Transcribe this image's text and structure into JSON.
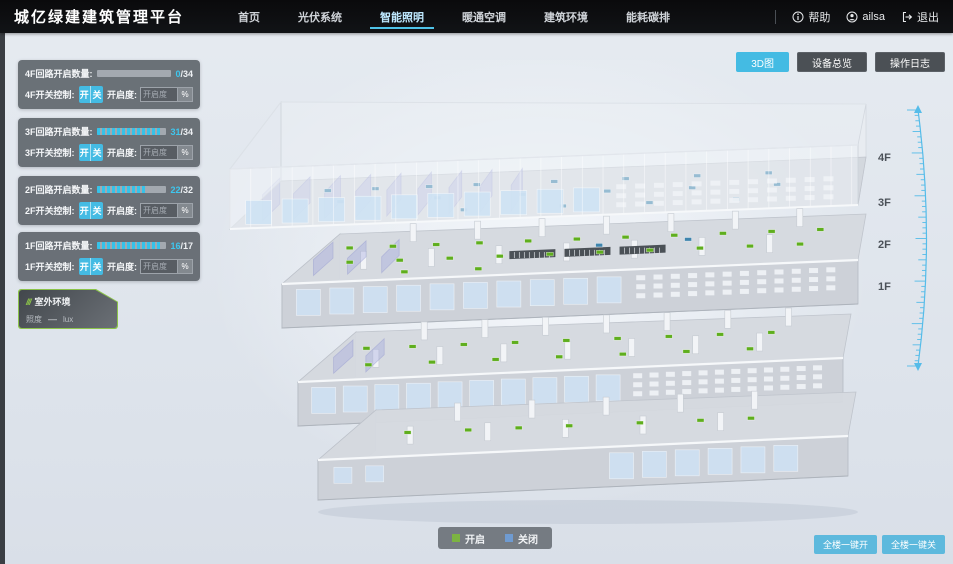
{
  "header": {
    "title": "城亿绿建建筑管理平台",
    "nav": [
      {
        "label": "首页",
        "active": false
      },
      {
        "label": "光伏系统",
        "active": false
      },
      {
        "label": "智能照明",
        "active": true
      },
      {
        "label": "暖通空调",
        "active": false
      },
      {
        "label": "建筑环境",
        "active": false
      },
      {
        "label": "能耗碳排",
        "active": false
      }
    ],
    "help": "帮助",
    "user": "ailsa",
    "logout": "退出"
  },
  "view_buttons": [
    {
      "label": "3D图",
      "active": true
    },
    {
      "label": "设备总览",
      "active": false
    },
    {
      "label": "操作日志",
      "active": false
    }
  ],
  "floor_panels": [
    {
      "count_label": "4F回路开启数量:",
      "num": "0",
      "den": "/34",
      "on": 0,
      "total": 34,
      "switch_label": "4F开关控制:",
      "on_btn": "开",
      "off_btn": "关",
      "dim_label": "开启度:",
      "dim_placeholder": "开启度",
      "percent_btn": "%"
    },
    {
      "count_label": "3F回路开启数量:",
      "num": "31",
      "den": "/34",
      "on": 31,
      "total": 34,
      "switch_label": "3F开关控制:",
      "on_btn": "开",
      "off_btn": "关",
      "dim_label": "开启度:",
      "dim_placeholder": "开启度",
      "percent_btn": "%"
    },
    {
      "count_label": "2F回路开启数量:",
      "num": "22",
      "den": "/32",
      "on": 22,
      "total": 32,
      "switch_label": "2F开关控制:",
      "on_btn": "开",
      "off_btn": "关",
      "dim_label": "开启度:",
      "dim_placeholder": "开启度",
      "percent_btn": "%"
    },
    {
      "count_label": "1F回路开启数量:",
      "num": "16",
      "den": "/17",
      "on": 16,
      "total": 17,
      "switch_label": "1F开关控制:",
      "on_btn": "开",
      "off_btn": "关",
      "dim_label": "开启度:",
      "dim_placeholder": "开启度",
      "percent_btn": "%"
    }
  ],
  "outdoor": {
    "title": "室外环境",
    "rows": [
      {
        "label": "照度",
        "value": "—",
        "unit": "lux"
      }
    ]
  },
  "floor_labels": [
    "4F",
    "3F",
    "2F",
    "1F"
  ],
  "legend": [
    {
      "label": "开启",
      "color": "#7cb342"
    },
    {
      "label": "关闭",
      "color": "#6f9bd1"
    }
  ],
  "bottom_buttons": [
    "全楼一键开",
    "全楼一键关"
  ],
  "accent_color": "#44bbe3",
  "scene": {
    "marker_on_color": "#5fae1e",
    "marker_off_color": "#3e84ad",
    "floors": [
      {
        "markers": [
          [
            0.1,
            0.75,
            "off"
          ],
          [
            0.18,
            0.75,
            "off"
          ],
          [
            0.27,
            0.75,
            "off"
          ],
          [
            0.35,
            0.75,
            "off"
          ],
          [
            0.48,
            0.75,
            "off"
          ],
          [
            0.6,
            0.75,
            "off"
          ],
          [
            0.72,
            0.75,
            "off"
          ],
          [
            0.84,
            0.75,
            "off"
          ],
          [
            0.14,
            0.5,
            "off"
          ],
          [
            0.3,
            0.5,
            "off"
          ],
          [
            0.44,
            0.5,
            "off"
          ],
          [
            0.58,
            0.5,
            "off"
          ],
          [
            0.72,
            0.5,
            "off"
          ],
          [
            0.86,
            0.5,
            "off"
          ],
          [
            0.36,
            0.22,
            "off"
          ],
          [
            0.52,
            0.22,
            "off"
          ],
          [
            0.66,
            0.22,
            "off"
          ],
          [
            0.8,
            0.22,
            "off"
          ]
        ]
      },
      {
        "markers": [
          [
            0.05,
            0.7,
            "on"
          ],
          [
            0.13,
            0.7,
            "on"
          ],
          [
            0.21,
            0.7,
            "on"
          ],
          [
            0.29,
            0.7,
            "on"
          ],
          [
            0.38,
            0.7,
            "on"
          ],
          [
            0.47,
            0.7,
            "on"
          ],
          [
            0.56,
            0.7,
            "on"
          ],
          [
            0.65,
            0.7,
            "on"
          ],
          [
            0.74,
            0.7,
            "on"
          ],
          [
            0.83,
            0.7,
            "on"
          ],
          [
            0.92,
            0.7,
            "on"
          ],
          [
            0.08,
            0.4,
            "on"
          ],
          [
            0.17,
            0.4,
            "on"
          ],
          [
            0.26,
            0.4,
            "on"
          ],
          [
            0.35,
            0.4,
            "on"
          ],
          [
            0.44,
            0.4,
            "on"
          ],
          [
            0.53,
            0.4,
            "on"
          ],
          [
            0.62,
            0.4,
            "on"
          ],
          [
            0.71,
            0.4,
            "on"
          ],
          [
            0.8,
            0.4,
            "on"
          ],
          [
            0.89,
            0.4,
            "on"
          ],
          [
            0.2,
            0.15,
            "on"
          ],
          [
            0.33,
            0.15,
            "on"
          ],
          [
            0.52,
            0.55,
            "off"
          ],
          [
            0.68,
            0.6,
            "off"
          ]
        ]
      },
      {
        "markers": [
          [
            0.06,
            0.65,
            "on"
          ],
          [
            0.15,
            0.65,
            "on"
          ],
          [
            0.25,
            0.65,
            "on"
          ],
          [
            0.35,
            0.65,
            "on"
          ],
          [
            0.45,
            0.65,
            "on"
          ],
          [
            0.55,
            0.65,
            "on"
          ],
          [
            0.65,
            0.65,
            "on"
          ],
          [
            0.75,
            0.65,
            "on"
          ],
          [
            0.85,
            0.65,
            "on"
          ],
          [
            0.1,
            0.3,
            "on"
          ],
          [
            0.22,
            0.3,
            "on"
          ],
          [
            0.34,
            0.3,
            "on"
          ],
          [
            0.46,
            0.3,
            "on"
          ],
          [
            0.58,
            0.3,
            "on"
          ],
          [
            0.7,
            0.3,
            "on"
          ],
          [
            0.82,
            0.3,
            "on"
          ]
        ]
      },
      {
        "markers": [
          [
            0.12,
            0.5,
            "on"
          ],
          [
            0.24,
            0.5,
            "on"
          ],
          [
            0.34,
            0.5,
            "on"
          ],
          [
            0.44,
            0.5,
            "on"
          ],
          [
            0.58,
            0.5,
            "on"
          ],
          [
            0.7,
            0.5,
            "on"
          ],
          [
            0.8,
            0.5,
            "on"
          ]
        ]
      }
    ]
  }
}
